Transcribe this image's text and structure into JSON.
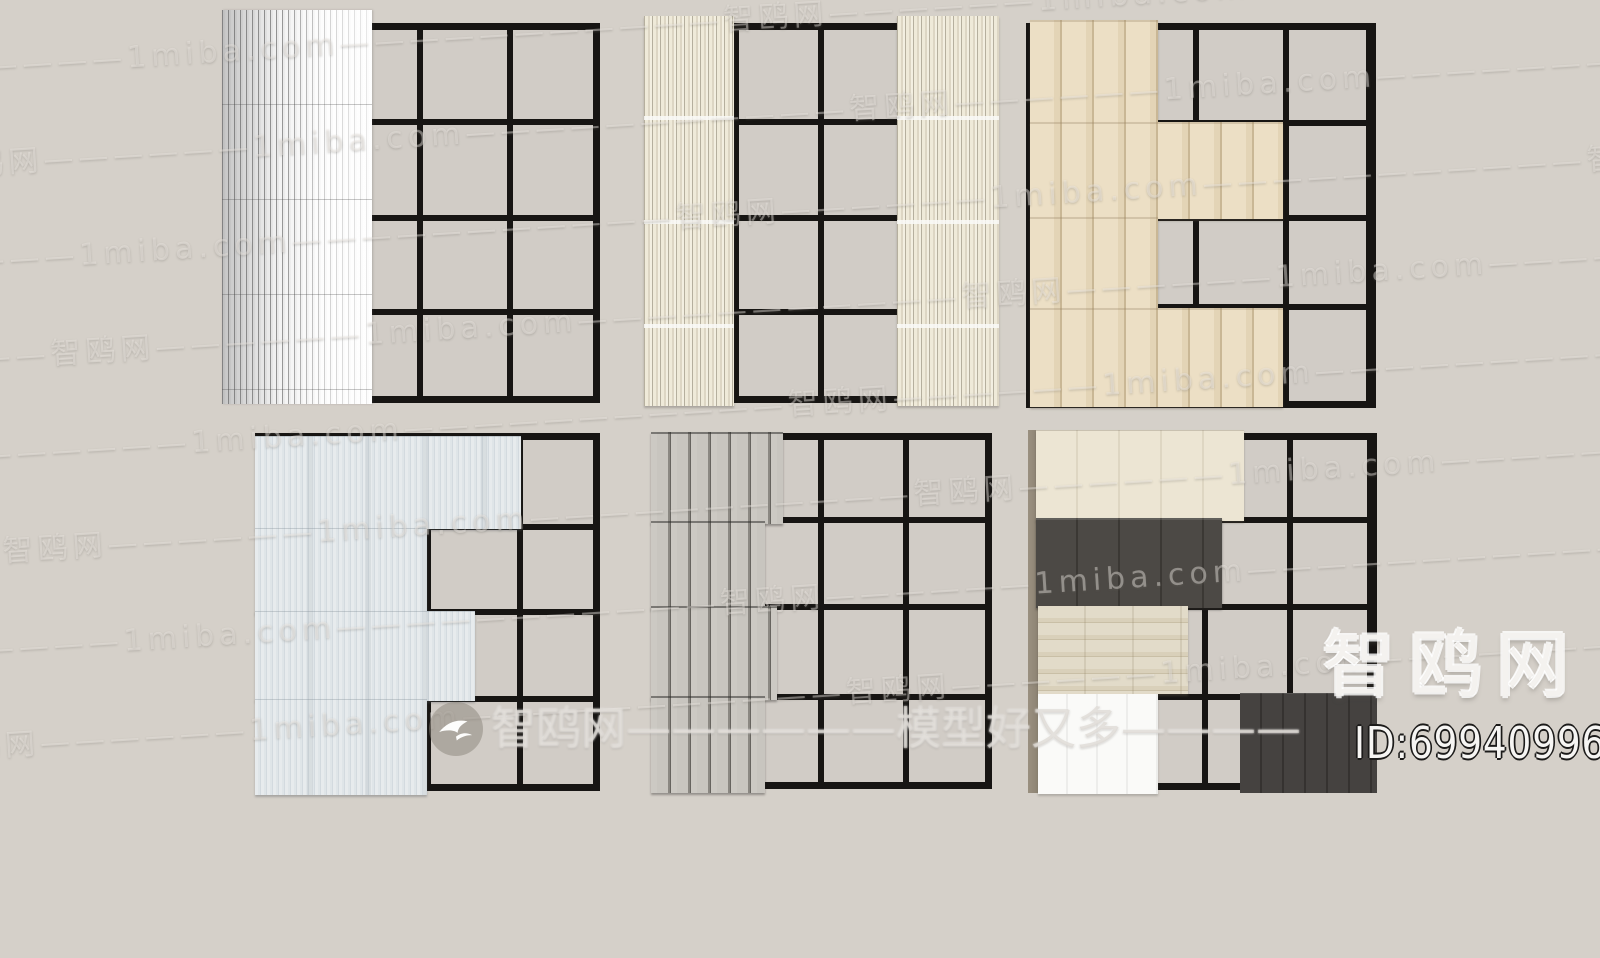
{
  "watermark": {
    "tile_text": "—————智鸥网——————1miba.com",
    "center_text": "智鸥网——————模型好又多————",
    "corner_brand": "智鸥网",
    "id_label": "ID:699409965",
    "logo_icon": "seagull-icon"
  },
  "colors": {
    "background": "#d5d0c9",
    "glass": "#d1ccc6",
    "frame": "#171513",
    "sheer_white": "#fdfdfd",
    "sheer_stripe": "#8a8a8a",
    "pleat_cream": "#efead9",
    "pleat_shadow": "#b5af9e",
    "beige_panel": "#ecdfc5",
    "beige_seam": "#c9b795",
    "pale_blue_panel": "#e6eaec",
    "pale_blue_streak": "#d3dadf",
    "gray_slat": "#c8c5bf",
    "gray_slat_seam": "#67645f",
    "ivory_panel": "#ece5d3",
    "charcoal_panel": "#4c4945",
    "greige_shade": "#d9d0ba",
    "white_panel": "#fafaf8",
    "dark_panel": "#454240",
    "rail_tan": "#8c8272",
    "watermark_tile": "#f4f1ec",
    "watermark_id": "#f6f5f3"
  }
}
